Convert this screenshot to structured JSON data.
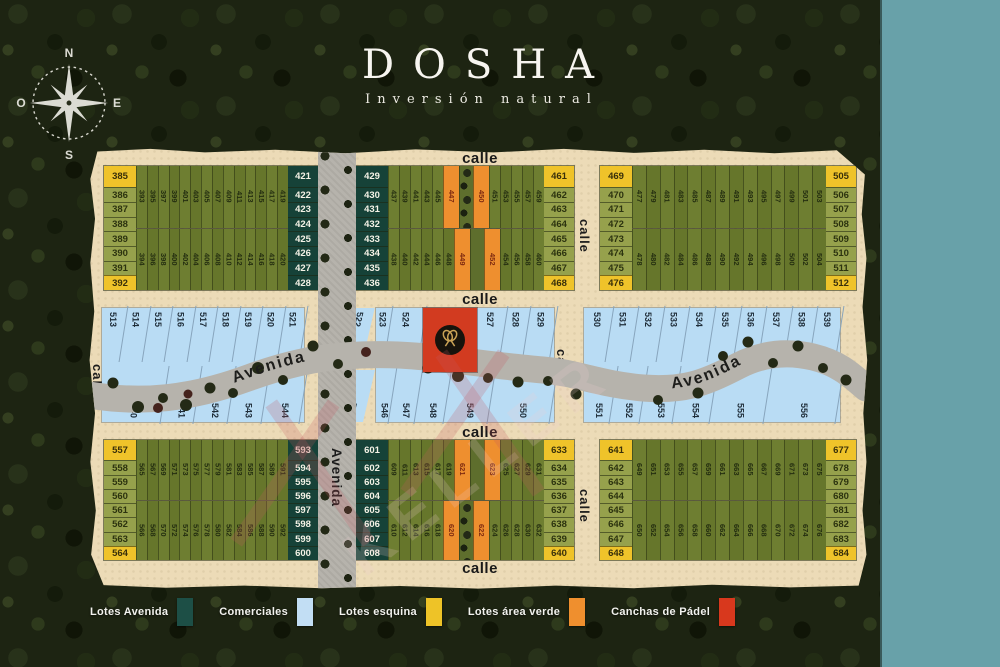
{
  "logo": {
    "title": "DOSHA",
    "subtitle": "Inversión natural"
  },
  "compass": {
    "n": "N",
    "s": "S",
    "e": "E",
    "o": "O"
  },
  "streets": {
    "calle": "calle",
    "avenida": "Avenida"
  },
  "watermark": {
    "text": "KELLER"
  },
  "colors": {
    "teal_panel": "#68a1a9",
    "paper": "#ecdbb7",
    "road": "#b6b3ac",
    "lot_green": "#6e7e31",
    "lot_dark": "#164238",
    "lot_yellow": "#efc32a",
    "lot_orange": "#ee8f2f",
    "lot_blue": "#b9dcf4",
    "padel_red": "#d23b20"
  },
  "blocks": {
    "top_left": {
      "left_col": [
        {
          "n": "385",
          "c": "y"
        },
        {
          "n": "386",
          "c": "g"
        },
        {
          "n": "387",
          "c": "g"
        },
        {
          "n": "388",
          "c": "g"
        },
        {
          "n": "389",
          "c": "g"
        },
        {
          "n": "390",
          "c": "g"
        },
        {
          "n": "391",
          "c": "g"
        },
        {
          "n": "392",
          "c": "y"
        }
      ],
      "strips_top": [
        {
          "n": "393"
        },
        {
          "n": "395"
        },
        {
          "n": "397"
        },
        {
          "n": "399"
        },
        {
          "n": "401"
        },
        {
          "n": "403"
        },
        {
          "n": "405"
        },
        {
          "n": "407"
        },
        {
          "n": "409"
        },
        {
          "n": "411"
        },
        {
          "n": "413"
        },
        {
          "n": "415"
        },
        {
          "n": "417"
        },
        {
          "n": "419"
        }
      ],
      "strips_bottom": [
        {
          "n": "394"
        },
        {
          "n": "396"
        },
        {
          "n": "398"
        },
        {
          "n": "400"
        },
        {
          "n": "402"
        },
        {
          "n": "404"
        },
        {
          "n": "406"
        },
        {
          "n": "408"
        },
        {
          "n": "410"
        },
        {
          "n": "412"
        },
        {
          "n": "414"
        },
        {
          "n": "416"
        },
        {
          "n": "418"
        },
        {
          "n": "420"
        }
      ],
      "right_col": [
        {
          "n": "421",
          "c": "d"
        },
        {
          "n": "422",
          "c": "d"
        },
        {
          "n": "423",
          "c": "d"
        },
        {
          "n": "424",
          "c": "d"
        },
        {
          "n": "425",
          "c": "d"
        },
        {
          "n": "426",
          "c": "d"
        },
        {
          "n": "427",
          "c": "d"
        },
        {
          "n": "428",
          "c": "d"
        }
      ]
    },
    "top_middle": {
      "left_col": [
        {
          "n": "429",
          "c": "d"
        },
        {
          "n": "430",
          "c": "d"
        },
        {
          "n": "431",
          "c": "d"
        },
        {
          "n": "432",
          "c": "d"
        },
        {
          "n": "433",
          "c": "d"
        },
        {
          "n": "434",
          "c": "d"
        },
        {
          "n": "435",
          "c": "d"
        },
        {
          "n": "436",
          "c": "d"
        }
      ],
      "strips_top": [
        {
          "n": "437"
        },
        {
          "n": "439"
        },
        {
          "n": "441"
        },
        {
          "n": "443"
        },
        {
          "n": "445"
        },
        {
          "n": "447",
          "t": "o"
        },
        {
          "t": "p"
        },
        {
          "n": "450",
          "t": "o"
        },
        {
          "n": "451"
        },
        {
          "n": "453"
        },
        {
          "n": "455"
        },
        {
          "n": "457"
        },
        {
          "n": "459"
        }
      ],
      "strips_bottom": [
        {
          "n": "438"
        },
        {
          "n": "440"
        },
        {
          "n": "442"
        },
        {
          "n": "444"
        },
        {
          "n": "446"
        },
        {
          "n": "448"
        },
        {
          "n": "449",
          "t": "o"
        },
        {
          "t": "p"
        },
        {
          "n": "452",
          "t": "o"
        },
        {
          "n": "454"
        },
        {
          "n": "456"
        },
        {
          "n": "458"
        },
        {
          "n": "460"
        }
      ],
      "right_col": [
        {
          "n": "461",
          "c": "y"
        },
        {
          "n": "462",
          "c": "g"
        },
        {
          "n": "463",
          "c": "g"
        },
        {
          "n": "464",
          "c": "g"
        },
        {
          "n": "465",
          "c": "g"
        },
        {
          "n": "466",
          "c": "g"
        },
        {
          "n": "467",
          "c": "g"
        },
        {
          "n": "468",
          "c": "y"
        }
      ]
    },
    "top_right": {
      "left_col": [
        {
          "n": "469",
          "c": "y"
        },
        {
          "n": "470",
          "c": "g"
        },
        {
          "n": "471",
          "c": "g"
        },
        {
          "n": "472",
          "c": "g"
        },
        {
          "n": "473",
          "c": "g"
        },
        {
          "n": "474",
          "c": "g"
        },
        {
          "n": "475",
          "c": "g"
        },
        {
          "n": "476",
          "c": "y"
        }
      ],
      "strips_top": [
        {
          "n": "477"
        },
        {
          "n": "479"
        },
        {
          "n": "481"
        },
        {
          "n": "483"
        },
        {
          "n": "485"
        },
        {
          "n": "487"
        },
        {
          "n": "489"
        },
        {
          "n": "491"
        },
        {
          "n": "493"
        },
        {
          "n": "495"
        },
        {
          "n": "497"
        },
        {
          "n": "499"
        },
        {
          "n": "501"
        },
        {
          "n": "503"
        }
      ],
      "strips_bottom": [
        {
          "n": "478"
        },
        {
          "n": "480"
        },
        {
          "n": "482"
        },
        {
          "n": "484"
        },
        {
          "n": "486"
        },
        {
          "n": "488"
        },
        {
          "n": "490"
        },
        {
          "n": "492"
        },
        {
          "n": "494"
        },
        {
          "n": "496"
        },
        {
          "n": "498"
        },
        {
          "n": "500"
        },
        {
          "n": "502"
        },
        {
          "n": "504"
        }
      ],
      "right_col": [
        {
          "n": "505",
          "c": "y"
        },
        {
          "n": "506",
          "c": "g"
        },
        {
          "n": "507",
          "c": "g"
        },
        {
          "n": "508",
          "c": "g"
        },
        {
          "n": "509",
          "c": "g"
        },
        {
          "n": "510",
          "c": "g"
        },
        {
          "n": "511",
          "c": "g"
        },
        {
          "n": "512",
          "c": "y"
        }
      ]
    },
    "bottom_left": {
      "left_col": [
        {
          "n": "557",
          "c": "y"
        },
        {
          "n": "558",
          "c": "g"
        },
        {
          "n": "559",
          "c": "g"
        },
        {
          "n": "560",
          "c": "g"
        },
        {
          "n": "561",
          "c": "g"
        },
        {
          "n": "562",
          "c": "g"
        },
        {
          "n": "563",
          "c": "g"
        },
        {
          "n": "564",
          "c": "y"
        }
      ],
      "strips_top": [
        {
          "n": "565"
        },
        {
          "n": "567"
        },
        {
          "n": "569"
        },
        {
          "n": "571"
        },
        {
          "n": "573"
        },
        {
          "n": "575"
        },
        {
          "n": "577"
        },
        {
          "n": "579"
        },
        {
          "n": "581"
        },
        {
          "n": "583"
        },
        {
          "n": "585"
        },
        {
          "n": "587"
        },
        {
          "n": "589"
        },
        {
          "n": "591"
        }
      ],
      "strips_bottom": [
        {
          "n": "566"
        },
        {
          "n": "568"
        },
        {
          "n": "570"
        },
        {
          "n": "572"
        },
        {
          "n": "574"
        },
        {
          "n": "576"
        },
        {
          "n": "578"
        },
        {
          "n": "580"
        },
        {
          "n": "582"
        },
        {
          "n": "584"
        },
        {
          "n": "586"
        },
        {
          "n": "588"
        },
        {
          "n": "590"
        },
        {
          "n": "592"
        }
      ],
      "right_col": [
        {
          "n": "593",
          "c": "d"
        },
        {
          "n": "594",
          "c": "d"
        },
        {
          "n": "595",
          "c": "d"
        },
        {
          "n": "596",
          "c": "d"
        },
        {
          "n": "597",
          "c": "d"
        },
        {
          "n": "598",
          "c": "d"
        },
        {
          "n": "599",
          "c": "d"
        },
        {
          "n": "600",
          "c": "d"
        }
      ]
    },
    "bottom_middle": {
      "left_col": [
        {
          "n": "601",
          "c": "d"
        },
        {
          "n": "602",
          "c": "d"
        },
        {
          "n": "603",
          "c": "d"
        },
        {
          "n": "604",
          "c": "d"
        },
        {
          "n": "605",
          "c": "d"
        },
        {
          "n": "606",
          "c": "d"
        },
        {
          "n": "607",
          "c": "d"
        },
        {
          "n": "608",
          "c": "d"
        }
      ],
      "strips_top": [
        {
          "n": "609"
        },
        {
          "n": "611"
        },
        {
          "n": "613"
        },
        {
          "n": "615"
        },
        {
          "n": "617"
        },
        {
          "n": "619"
        },
        {
          "n": "621",
          "t": "o"
        },
        {
          "t": "p"
        },
        {
          "n": "623",
          "t": "o"
        },
        {
          "n": "625"
        },
        {
          "n": "627"
        },
        {
          "n": "629"
        },
        {
          "n": "631"
        }
      ],
      "strips_bottom": [
        {
          "n": "610"
        },
        {
          "n": "612"
        },
        {
          "n": "614"
        },
        {
          "n": "616"
        },
        {
          "n": "618"
        },
        {
          "n": "620",
          "t": "o"
        },
        {
          "t": "p"
        },
        {
          "n": "622",
          "t": "o"
        },
        {
          "n": "624"
        },
        {
          "n": "626"
        },
        {
          "n": "628"
        },
        {
          "n": "630"
        },
        {
          "n": "632"
        }
      ],
      "right_col": [
        {
          "n": "633",
          "c": "y"
        },
        {
          "n": "634",
          "c": "g"
        },
        {
          "n": "635",
          "c": "g"
        },
        {
          "n": "636",
          "c": "g"
        },
        {
          "n": "637",
          "c": "g"
        },
        {
          "n": "638",
          "c": "g"
        },
        {
          "n": "639",
          "c": "g"
        },
        {
          "n": "640",
          "c": "y"
        }
      ]
    },
    "bottom_right": {
      "left_col": [
        {
          "n": "641",
          "c": "y"
        },
        {
          "n": "642",
          "c": "g"
        },
        {
          "n": "643",
          "c": "g"
        },
        {
          "n": "644",
          "c": "g"
        },
        {
          "n": "645",
          "c": "g"
        },
        {
          "n": "646",
          "c": "g"
        },
        {
          "n": "647",
          "c": "g"
        },
        {
          "n": "648",
          "c": "y"
        }
      ],
      "strips_top": [
        {
          "n": "649"
        },
        {
          "n": "651"
        },
        {
          "n": "653"
        },
        {
          "n": "655"
        },
        {
          "n": "657"
        },
        {
          "n": "659"
        },
        {
          "n": "661"
        },
        {
          "n": "663"
        },
        {
          "n": "665"
        },
        {
          "n": "667"
        },
        {
          "n": "669"
        },
        {
          "n": "671"
        },
        {
          "n": "673"
        },
        {
          "n": "675"
        }
      ],
      "strips_bottom": [
        {
          "n": "650"
        },
        {
          "n": "652"
        },
        {
          "n": "654"
        },
        {
          "n": "656"
        },
        {
          "n": "658"
        },
        {
          "n": "660"
        },
        {
          "n": "662"
        },
        {
          "n": "664"
        },
        {
          "n": "666"
        },
        {
          "n": "668"
        },
        {
          "n": "670"
        },
        {
          "n": "672"
        },
        {
          "n": "674"
        },
        {
          "n": "676"
        }
      ],
      "right_col": [
        {
          "n": "677",
          "c": "y"
        },
        {
          "n": "678",
          "c": "g"
        },
        {
          "n": "679",
          "c": "g"
        },
        {
          "n": "680",
          "c": "g"
        },
        {
          "n": "681",
          "c": "g"
        },
        {
          "n": "682",
          "c": "g"
        },
        {
          "n": "683",
          "c": "g"
        },
        {
          "n": "684",
          "c": "y"
        }
      ]
    }
  },
  "commercial": {
    "left_top": [
      {
        "n": "513"
      },
      {
        "n": "514"
      },
      {
        "n": "515"
      },
      {
        "n": "516"
      },
      {
        "n": "517"
      },
      {
        "n": "518"
      },
      {
        "n": "519"
      },
      {
        "n": "520"
      },
      {
        "n": "521"
      }
    ],
    "left_bottom": [
      {
        "n": "540",
        "f": "2.6"
      },
      {
        "n": "541",
        "f": "1.4"
      },
      {
        "n": "542",
        "f": "1.4"
      },
      {
        "n": "543",
        "f": "1.4"
      },
      {
        "n": "544",
        "f": "1.6"
      }
    ],
    "cross_top": "522",
    "cross_bottom": "545",
    "center_top_left": [
      {
        "n": "523",
        "f": "0.7"
      },
      {
        "n": "524",
        "f": "1.9"
      }
    ],
    "center_top_right": [
      {
        "n": "527",
        "f": "1.5"
      },
      {
        "n": "528",
        "f": "1.3"
      },
      {
        "n": "529",
        "f": "1.5"
      }
    ],
    "center_bottom": [
      {
        "n": "546",
        "f": "0.9"
      },
      {
        "n": "547",
        "f": "1.3"
      },
      {
        "n": "548",
        "f": "1.5"
      },
      {
        "n": "549",
        "f": "2.3"
      },
      {
        "n": "550",
        "f": "3.2"
      }
    ],
    "right_top": [
      {
        "n": "530"
      },
      {
        "n": "531"
      },
      {
        "n": "532"
      },
      {
        "n": "533"
      },
      {
        "n": "534"
      },
      {
        "n": "535"
      },
      {
        "n": "536"
      },
      {
        "n": "537"
      },
      {
        "n": "538"
      },
      {
        "n": "539"
      }
    ],
    "right_bottom": [
      {
        "n": "551",
        "f": "1"
      },
      {
        "n": "552",
        "f": "1"
      },
      {
        "n": "553",
        "f": "1.1"
      },
      {
        "n": "554",
        "f": "1.2"
      },
      {
        "n": "555",
        "f": "1.8"
      },
      {
        "n": "556",
        "f": "2.4"
      }
    ]
  },
  "legend": {
    "items": [
      {
        "label": "Lotes Avenida",
        "color": "#1d4f46"
      },
      {
        "label": "Comerciales",
        "color": "#c2def4"
      },
      {
        "label": "Lotes esquina",
        "color": "#eec327"
      },
      {
        "label": "Lotes área verde",
        "color": "#ef8f2e"
      },
      {
        "label": "Canchas de Pádel",
        "color": "#d8381d"
      }
    ]
  }
}
